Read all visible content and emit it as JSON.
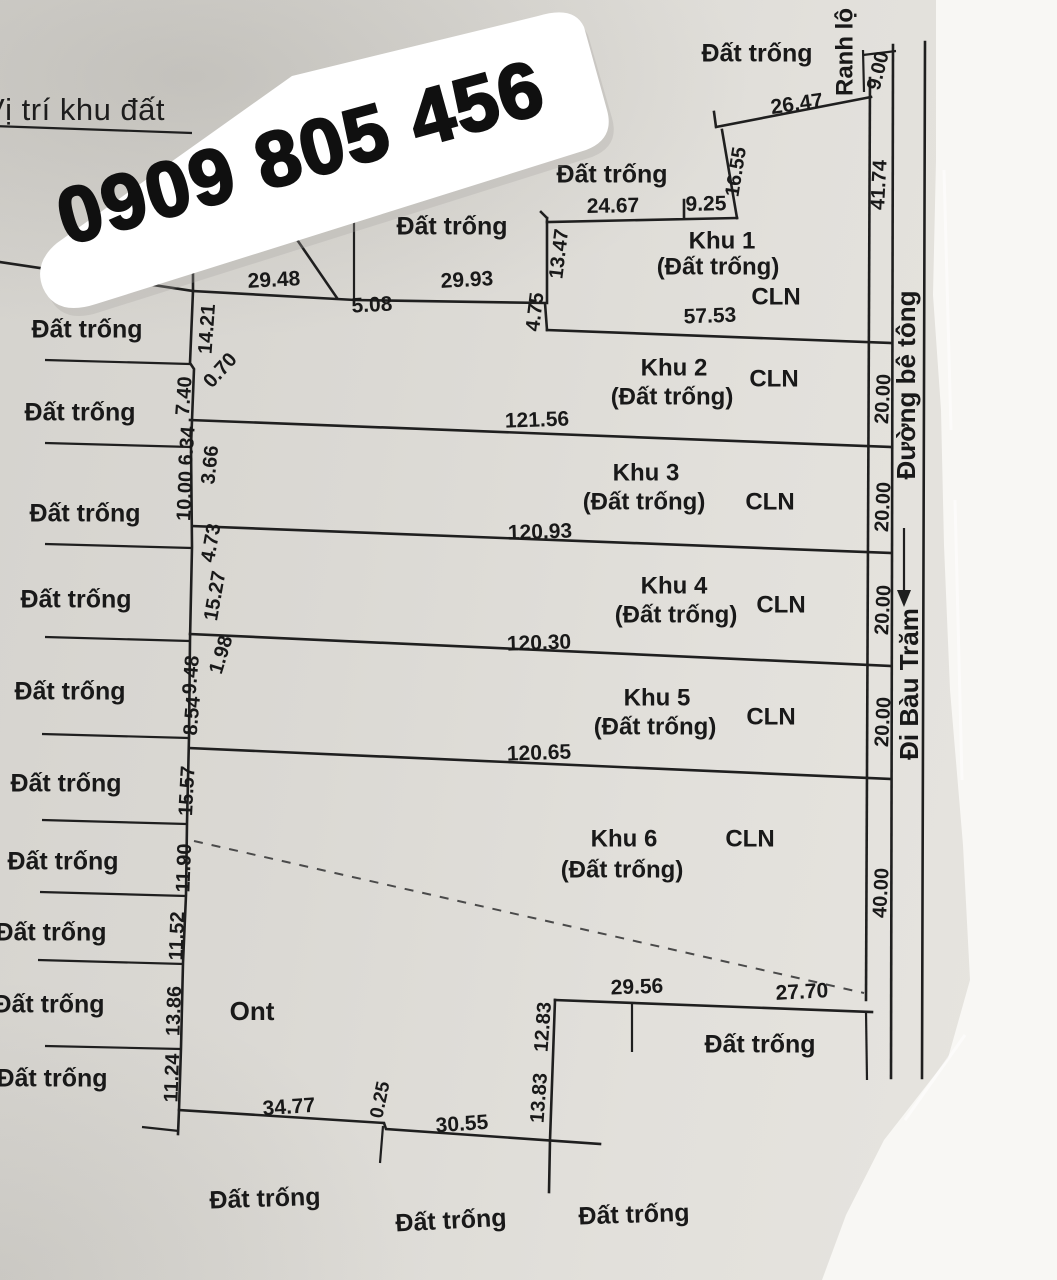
{
  "title": "Vị trí khu đất",
  "phone": "0909 805 456",
  "diagram": {
    "area_labels": [
      {
        "name": "dat-trong-top-1",
        "text": "Đất trống",
        "x": 757,
        "y": 55,
        "rot": 0,
        "size": 25,
        "w": 600
      },
      {
        "name": "dat-trong-top-2",
        "text": "Đất trống",
        "x": 612,
        "y": 176,
        "rot": 0,
        "size": 25,
        "w": 600
      },
      {
        "name": "dat-trong-top-3",
        "text": "Đất trống",
        "x": 452,
        "y": 228,
        "rot": 0,
        "size": 25,
        "w": 600
      },
      {
        "name": "dat-trong-left-1",
        "text": "Đất trống",
        "x": 87,
        "y": 331,
        "rot": 0,
        "size": 25,
        "w": 600
      },
      {
        "name": "dat-trong-left-2",
        "text": "Đất trống",
        "x": 80,
        "y": 414,
        "rot": 0,
        "size": 25,
        "w": 600
      },
      {
        "name": "dat-trong-left-3",
        "text": "Đất trống",
        "x": 85,
        "y": 515,
        "rot": 0,
        "size": 25,
        "w": 600
      },
      {
        "name": "dat-trong-left-4",
        "text": "Đất trống",
        "x": 76,
        "y": 601,
        "rot": 0,
        "size": 25,
        "w": 600
      },
      {
        "name": "dat-trong-left-5",
        "text": "Đất trống",
        "x": 70,
        "y": 693,
        "rot": 0,
        "size": 25,
        "w": 600
      },
      {
        "name": "dat-trong-left-6",
        "text": "Đất trống",
        "x": 66,
        "y": 785,
        "rot": 0,
        "size": 25,
        "w": 600
      },
      {
        "name": "dat-trong-left-7",
        "text": "Đất trống",
        "x": 63,
        "y": 863,
        "rot": 0,
        "size": 25,
        "w": 600
      },
      {
        "name": "dat-trong-left-8",
        "text": "Đất trống",
        "x": 51,
        "y": 934,
        "rot": 0,
        "size": 25,
        "w": 600
      },
      {
        "name": "dat-trong-left-9",
        "text": "Đất trống",
        "x": 49,
        "y": 1006,
        "rot": 0,
        "size": 25,
        "w": 600
      },
      {
        "name": "dat-trong-left-10",
        "text": "Đất trống",
        "x": 52,
        "y": 1080,
        "rot": 0,
        "size": 25,
        "w": 600
      },
      {
        "name": "ont-label",
        "text": "Ont",
        "x": 252,
        "y": 1013,
        "rot": 0,
        "size": 26,
        "w": 600
      },
      {
        "name": "dat-trong-notch",
        "text": "Đất trống",
        "x": 760,
        "y": 1046,
        "rot": 0,
        "size": 25,
        "w": 600
      },
      {
        "name": "dat-trong-bottom-1",
        "text": "Đất trống",
        "x": 265,
        "y": 1200,
        "rot": -2,
        "size": 25,
        "w": 600
      },
      {
        "name": "dat-trong-bottom-2",
        "text": "Đất trống",
        "x": 451,
        "y": 1222,
        "rot": -3,
        "size": 25,
        "w": 600
      },
      {
        "name": "dat-trong-bottom-3",
        "text": "Đất trống",
        "x": 634,
        "y": 1216,
        "rot": -2,
        "size": 25,
        "w": 600
      }
    ],
    "plot_labels": [
      {
        "name": "khu-1-name",
        "text": "Khu 1",
        "x": 722,
        "y": 242,
        "rot": 0,
        "size": 24,
        "w": 600
      },
      {
        "name": "khu-1-status",
        "text": "(Đất trống)",
        "x": 718,
        "y": 268,
        "rot": 0,
        "size": 24,
        "w": 600
      },
      {
        "name": "khu-1-landuse",
        "text": "CLN",
        "x": 776,
        "y": 298,
        "rot": 0,
        "size": 24,
        "w": 600
      },
      {
        "name": "khu-2-name",
        "text": "Khu 2",
        "x": 674,
        "y": 369,
        "rot": 0,
        "size": 24,
        "w": 600
      },
      {
        "name": "khu-2-status",
        "text": "(Đất trống)",
        "x": 672,
        "y": 398,
        "rot": 0,
        "size": 24,
        "w": 600
      },
      {
        "name": "khu-2-landuse",
        "text": "CLN",
        "x": 774,
        "y": 380,
        "rot": 0,
        "size": 24,
        "w": 600
      },
      {
        "name": "khu-3-name",
        "text": "Khu 3",
        "x": 646,
        "y": 474,
        "rot": 0,
        "size": 24,
        "w": 600
      },
      {
        "name": "khu-3-status",
        "text": "(Đất trống)",
        "x": 644,
        "y": 503,
        "rot": 0,
        "size": 24,
        "w": 600
      },
      {
        "name": "khu-3-landuse",
        "text": "CLN",
        "x": 770,
        "y": 503,
        "rot": 0,
        "size": 24,
        "w": 600
      },
      {
        "name": "khu-4-name",
        "text": "Khu 4",
        "x": 674,
        "y": 587,
        "rot": 0,
        "size": 24,
        "w": 600
      },
      {
        "name": "khu-4-status",
        "text": "(Đất trống)",
        "x": 676,
        "y": 616,
        "rot": 0,
        "size": 24,
        "w": 600
      },
      {
        "name": "khu-4-landuse",
        "text": "CLN",
        "x": 781,
        "y": 606,
        "rot": 0,
        "size": 24,
        "w": 600
      },
      {
        "name": "khu-5-name",
        "text": "Khu 5",
        "x": 657,
        "y": 699,
        "rot": 0,
        "size": 24,
        "w": 600
      },
      {
        "name": "khu-5-status",
        "text": "(Đất trống)",
        "x": 655,
        "y": 728,
        "rot": 0,
        "size": 24,
        "w": 600
      },
      {
        "name": "khu-5-landuse",
        "text": "CLN",
        "x": 771,
        "y": 718,
        "rot": 0,
        "size": 24,
        "w": 600
      },
      {
        "name": "khu-6-name",
        "text": "Khu 6",
        "x": 624,
        "y": 840,
        "rot": 0,
        "size": 24,
        "w": 600
      },
      {
        "name": "khu-6-status",
        "text": "(Đất trống)",
        "x": 622,
        "y": 871,
        "rot": 0,
        "size": 24,
        "w": 600
      },
      {
        "name": "khu-6-landuse",
        "text": "CLN",
        "x": 750,
        "y": 840,
        "rot": 0,
        "size": 24,
        "w": 600
      }
    ],
    "dimensions": [
      {
        "name": "dim-26-47",
        "text": "26.47",
        "x": 797,
        "y": 105,
        "rot": -8,
        "size": 21,
        "w": 700
      },
      {
        "name": "dim-16-55",
        "text": "16.55",
        "x": 737,
        "y": 172,
        "rot": -81,
        "size": 20,
        "w": 700
      },
      {
        "name": "dim-24-67",
        "text": "24.67",
        "x": 613,
        "y": 207,
        "rot": -1,
        "size": 21,
        "w": 700
      },
      {
        "name": "dim-9-25",
        "text": "9.25",
        "x": 706,
        "y": 205,
        "rot": -1,
        "size": 21,
        "w": 700
      },
      {
        "name": "dim-13-47",
        "text": "13.47",
        "x": 560,
        "y": 254,
        "rot": -83,
        "size": 20,
        "w": 700
      },
      {
        "name": "dim-4-75",
        "text": "4.75",
        "x": 536,
        "y": 312,
        "rot": -83,
        "size": 20,
        "w": 700
      },
      {
        "name": "dim-57-53",
        "text": "57.53",
        "x": 710,
        "y": 317,
        "rot": -2,
        "size": 21,
        "w": 700
      },
      {
        "name": "dim-29-48",
        "text": "29.48",
        "x": 274,
        "y": 281,
        "rot": -3,
        "size": 21,
        "w": 700
      },
      {
        "name": "dim-5-08",
        "text": "5.08",
        "x": 372,
        "y": 306,
        "rot": -3,
        "size": 21,
        "w": 700
      },
      {
        "name": "dim-29-93",
        "text": "29.93",
        "x": 467,
        "y": 281,
        "rot": -3,
        "size": 21,
        "w": 700
      },
      {
        "name": "dim-9-00",
        "text": "9.00",
        "x": 879,
        "y": 71,
        "rot": -76,
        "size": 20,
        "w": 700
      },
      {
        "name": "dim-121-56",
        "text": "121.56",
        "x": 537,
        "y": 421,
        "rot": -2,
        "size": 21,
        "w": 700
      },
      {
        "name": "dim-120-93",
        "text": "120.93",
        "x": 540,
        "y": 533,
        "rot": -2,
        "size": 21,
        "w": 700
      },
      {
        "name": "dim-120-30",
        "text": "120.30",
        "x": 539,
        "y": 644,
        "rot": -2,
        "size": 21,
        "w": 700
      },
      {
        "name": "dim-120-65",
        "text": "120.65",
        "x": 539,
        "y": 754,
        "rot": -2,
        "size": 21,
        "w": 700
      },
      {
        "name": "dim-41-74",
        "text": "41.74",
        "x": 880,
        "y": 185,
        "rot": -87,
        "size": 20,
        "w": 700
      },
      {
        "name": "dim-20-00-khu2",
        "text": "20.00",
        "x": 884,
        "y": 399,
        "rot": -87,
        "size": 20,
        "w": 700
      },
      {
        "name": "dim-20-00-khu3",
        "text": "20.00",
        "x": 884,
        "y": 507,
        "rot": -87,
        "size": 20,
        "w": 700
      },
      {
        "name": "dim-20-00-khu4",
        "text": "20.00",
        "x": 884,
        "y": 610,
        "rot": -87,
        "size": 20,
        "w": 700
      },
      {
        "name": "dim-20-00-khu5",
        "text": "20.00",
        "x": 884,
        "y": 722,
        "rot": -87,
        "size": 20,
        "w": 700
      },
      {
        "name": "dim-40-00",
        "text": "40.00",
        "x": 882,
        "y": 893,
        "rot": -87,
        "size": 20,
        "w": 700
      },
      {
        "name": "dim-14-21",
        "text": "14.21",
        "x": 208,
        "y": 329,
        "rot": -86,
        "size": 20,
        "w": 700
      },
      {
        "name": "dim-0-70",
        "text": "0.70",
        "x": 221,
        "y": 371,
        "rot": -48,
        "size": 20,
        "w": 700
      },
      {
        "name": "dim-7-40",
        "text": "7.40",
        "x": 185,
        "y": 396,
        "rot": -86,
        "size": 20,
        "w": 700
      },
      {
        "name": "dim-6-34",
        "text": "6.34",
        "x": 188,
        "y": 446,
        "rot": -86,
        "size": 20,
        "w": 700
      },
      {
        "name": "dim-3-66",
        "text": "3.66",
        "x": 211,
        "y": 465,
        "rot": -84,
        "size": 20,
        "w": 700
      },
      {
        "name": "dim-10-00",
        "text": "10.00",
        "x": 186,
        "y": 496,
        "rot": -87,
        "size": 20,
        "w": 700
      },
      {
        "name": "dim-4-73",
        "text": "4.73",
        "x": 212,
        "y": 543,
        "rot": -80,
        "size": 20,
        "w": 700
      },
      {
        "name": "dim-15-27",
        "text": "15.27",
        "x": 216,
        "y": 596,
        "rot": -80,
        "size": 20,
        "w": 700
      },
      {
        "name": "dim-1-98",
        "text": "1.98",
        "x": 222,
        "y": 655,
        "rot": -73,
        "size": 20,
        "w": 700
      },
      {
        "name": "dim-9-48",
        "text": "9.48",
        "x": 192,
        "y": 675,
        "rot": -85,
        "size": 20,
        "w": 700
      },
      {
        "name": "dim-8-54",
        "text": "8.54",
        "x": 193,
        "y": 716,
        "rot": -85,
        "size": 20,
        "w": 700
      },
      {
        "name": "dim-15-57",
        "text": "15.57",
        "x": 188,
        "y": 791,
        "rot": -87,
        "size": 20,
        "w": 700
      },
      {
        "name": "dim-11-90",
        "text": "11.90",
        "x": 185,
        "y": 868,
        "rot": -88,
        "size": 20,
        "w": 700
      },
      {
        "name": "dim-11-52",
        "text": "11.52",
        "x": 178,
        "y": 936,
        "rot": -88,
        "size": 20,
        "w": 700
      },
      {
        "name": "dim-13-86",
        "text": "13.86",
        "x": 175,
        "y": 1011,
        "rot": -88,
        "size": 20,
        "w": 700
      },
      {
        "name": "dim-11-24",
        "text": "11.24",
        "x": 173,
        "y": 1078,
        "rot": -88,
        "size": 20,
        "w": 700
      },
      {
        "name": "dim-34-77",
        "text": "34.77",
        "x": 289,
        "y": 1108,
        "rot": -4,
        "size": 21,
        "w": 700
      },
      {
        "name": "dim-0-25",
        "text": "0.25",
        "x": 381,
        "y": 1100,
        "rot": -78,
        "size": 19,
        "w": 700
      },
      {
        "name": "dim-30-55",
        "text": "30.55",
        "x": 462,
        "y": 1125,
        "rot": -4,
        "size": 21,
        "w": 700
      },
      {
        "name": "dim-13-83",
        "text": "13.83",
        "x": 540,
        "y": 1098,
        "rot": -86,
        "size": 20,
        "w": 700
      },
      {
        "name": "dim-12-83",
        "text": "12.83",
        "x": 544,
        "y": 1027,
        "rot": -86,
        "size": 20,
        "w": 700
      },
      {
        "name": "dim-29-56",
        "text": "29.56",
        "x": 637,
        "y": 988,
        "rot": -2,
        "size": 21,
        "w": 700
      },
      {
        "name": "dim-27-70",
        "text": "27.70",
        "x": 802,
        "y": 993,
        "rot": -3,
        "size": 21,
        "w": 700
      }
    ],
    "road": [
      {
        "name": "road-label-ranh-lo",
        "text": "Ranh lộ",
        "x": 846,
        "y": 52,
        "rot": -90,
        "size": 24,
        "w": 600
      },
      {
        "name": "road-label-duong-be-tong",
        "text": "Đường bê tông",
        "x": 908,
        "y": 385,
        "rot": -90,
        "size": 26,
        "w": 600
      },
      {
        "name": "road-label-di-bau-tram",
        "text": "Đi Bàu Trăm",
        "x": 911,
        "y": 684,
        "rot": -90,
        "size": 26,
        "w": 600
      }
    ]
  }
}
